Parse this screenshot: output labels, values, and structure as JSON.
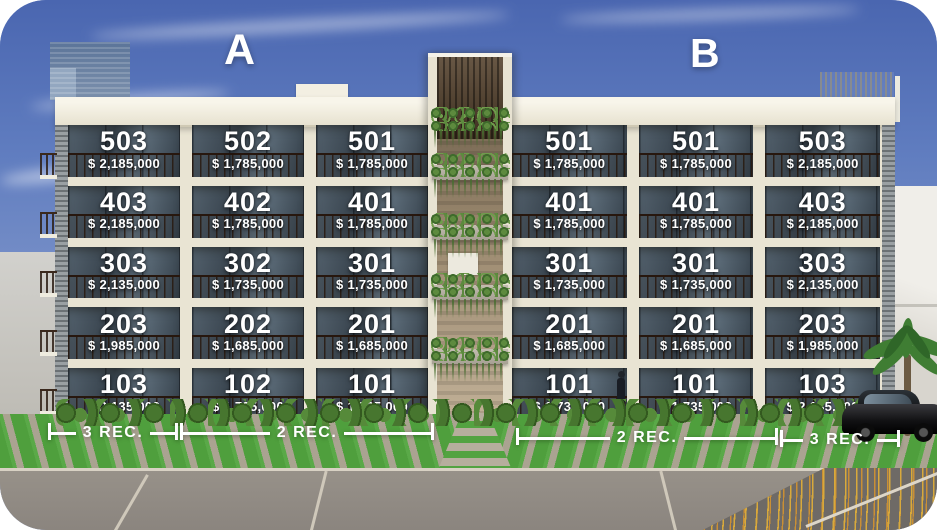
{
  "section_labels": {
    "a": "A",
    "b": "B"
  },
  "sections": [
    {
      "name": "A",
      "units": [
        {
          "number": "503",
          "price": "$ 2,185,000"
        },
        {
          "number": "502",
          "price": "$ 1,785,000"
        },
        {
          "number": "501",
          "price": "$ 1,785,000"
        },
        {
          "number": "403",
          "price": "$ 2,185,000"
        },
        {
          "number": "402",
          "price": "$ 1,785,000"
        },
        {
          "number": "401",
          "price": "$ 1,785,000"
        },
        {
          "number": "303",
          "price": "$ 2,135,000"
        },
        {
          "number": "302",
          "price": "$ 1,735,000"
        },
        {
          "number": "301",
          "price": "$ 1,735,000"
        },
        {
          "number": "203",
          "price": "$ 1,985,000"
        },
        {
          "number": "202",
          "price": "$ 1,685,000"
        },
        {
          "number": "201",
          "price": "$ 1,685,000"
        },
        {
          "number": "103",
          "price": "$ 2,135,000"
        },
        {
          "number": "102",
          "price": "$ 1,735,000"
        },
        {
          "number": "101",
          "price": "$ 1,735,000"
        }
      ]
    },
    {
      "name": "B",
      "units": [
        {
          "number": "501",
          "price": "$ 1,785,000"
        },
        {
          "number": "501",
          "price": "$ 1,785,000"
        },
        {
          "number": "503",
          "price": "$ 2,185,000"
        },
        {
          "number": "401",
          "price": "$ 1,785,000"
        },
        {
          "number": "401",
          "price": "$ 1,785,000"
        },
        {
          "number": "403",
          "price": "$ 2,185,000"
        },
        {
          "number": "301",
          "price": "$ 1,735,000"
        },
        {
          "number": "301",
          "price": "$ 1,735,000"
        },
        {
          "number": "303",
          "price": "$ 2,135,000"
        },
        {
          "number": "201",
          "price": "$ 1,685,000"
        },
        {
          "number": "201",
          "price": "$ 1,685,000"
        },
        {
          "number": "203",
          "price": "$ 1,985,000"
        },
        {
          "number": "101",
          "price": "$ 1,735,000"
        },
        {
          "number": "101",
          "price": "$ 1,735,000"
        },
        {
          "number": "103",
          "price": "$ 2,135,000"
        }
      ]
    }
  ],
  "rec_brackets": [
    {
      "label": "3 REC."
    },
    {
      "label": "2 REC."
    },
    {
      "label": "2 REC."
    },
    {
      "label": "3 REC."
    }
  ],
  "palette": {
    "sky_top": "#4a66b0",
    "facade_cream": "#e9e4d3",
    "glass_dark": "#39444e",
    "grass_green": "#4f9f3d",
    "wood_brown": "#53402b",
    "label_text": "#ffffff"
  }
}
